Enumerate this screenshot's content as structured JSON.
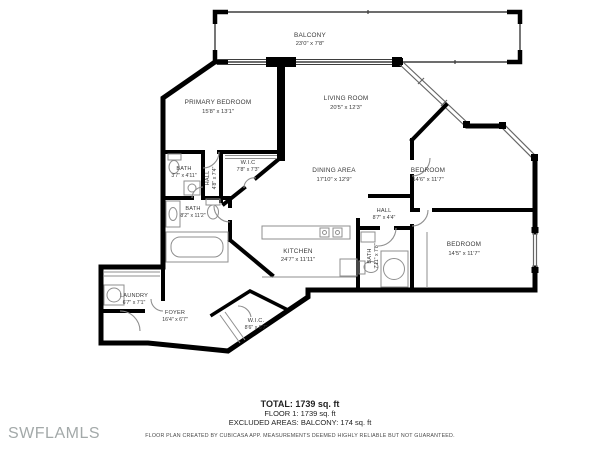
{
  "colors": {
    "wall": "#000000",
    "thin_line": "#3d3d3d",
    "fixture": "#8f8f8f",
    "label": "#3a3a3a",
    "watermark": "#a3a9a9",
    "background": "#ffffff"
  },
  "watermark": "SWFLAMLS",
  "rooms": [
    {
      "id": "balcony",
      "name": "BALCONY",
      "dims": "23'0\" x 7'8\""
    },
    {
      "id": "primary-bedroom",
      "name": "PRIMARY BEDROOM",
      "dims": "15'8\" x 13'1\""
    },
    {
      "id": "living-room",
      "name": "LIVING ROOM",
      "dims": "20'5\" x 12'3\""
    },
    {
      "id": "bath-1",
      "name": "BATH",
      "dims": "3'7\" x 4'11\""
    },
    {
      "id": "hall-1",
      "name": "HALL",
      "dims": "4'8\" x 7'4\""
    },
    {
      "id": "wic-1",
      "name": "W.I.C",
      "dims": "7'8\" x 7'3\""
    },
    {
      "id": "bath-2",
      "name": "BATH",
      "dims": "8'2\" x 11'2\""
    },
    {
      "id": "dining-area",
      "name": "DINING AREA",
      "dims": "17'10\" x 12'9\""
    },
    {
      "id": "bedroom-1",
      "name": "BEDROOM",
      "dims": "14'6\" x 11'7\""
    },
    {
      "id": "hall-2",
      "name": "HALL",
      "dims": "8'7\" x 4'4\""
    },
    {
      "id": "bath-3",
      "name": "BATH",
      "dims": "7'11\" x 7'8\""
    },
    {
      "id": "bedroom-2",
      "name": "BEDROOM",
      "dims": "14'5\" x 11'7\""
    },
    {
      "id": "kitchen",
      "name": "KITCHEN",
      "dims": "24'7\" x 11'11\""
    },
    {
      "id": "laundry",
      "name": "LAUNDRY",
      "dims": "6'7\" x 7'1\""
    },
    {
      "id": "foyer",
      "name": "FOYER",
      "dims": "16'4\" x 6'7\""
    },
    {
      "id": "wic-2",
      "name": "W.I.C.",
      "dims": "8'6\" x 6'7\""
    }
  ],
  "summary": {
    "total": "TOTAL: 1739 sq. ft",
    "floor": "FLOOR 1: 1739 sq. ft",
    "excluded": "EXCLUDED AREAS: BALCONY: 174 sq. ft",
    "disclaimer": "FLOOR PLAN CREATED BY CUBICASA APP. MEASUREMENTS DEEMED HIGHLY RELIABLE BUT NOT GUARANTEED."
  }
}
